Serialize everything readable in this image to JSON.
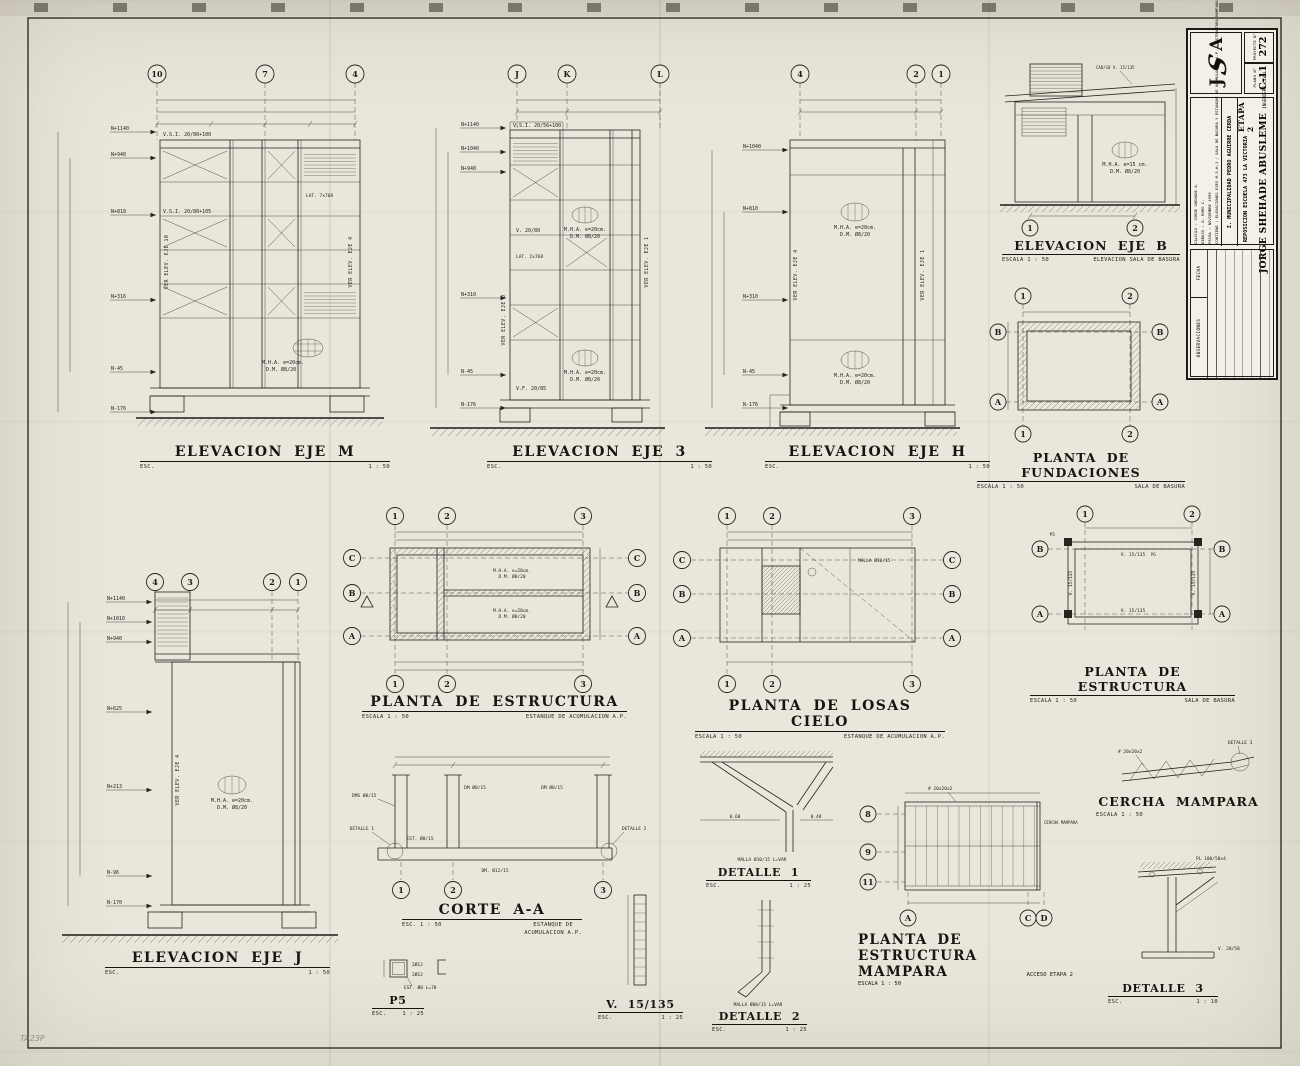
{
  "sheet": {
    "corner_mark": "TA23P"
  },
  "tb": {
    "logo_j": "J",
    "logo_s": "S",
    "logo_a": "A",
    "proj_no_label": "PROYECTO N°",
    "proj_no": "272",
    "plan_no_label": "PLANO N°",
    "plan_no": "C-11",
    "engineer": "JORGE SHEHADE ABUSLEME",
    "eng_title": "INGENIERO CIVIL",
    "etapa": "ETAPA 2",
    "proy_label": "PROYECTO :",
    "proy": "REPOSICION ESCUELA 473 LA VICTORIA",
    "cli_label": "CLIENTE :",
    "cli": "I. MUNICIPALIDAD PEDRO AGUIRRE CERDA",
    "f1": "CALCULO : JORGE SHEHADE A.",
    "f2": "DIBUJO : A. ROMO C.",
    "f3": "FECHA : NOVIEMBRE 1999",
    "contiene": "CONTIENE : ELEVACIONES EJES M-3-H-J / SALA DE BASURA Y ESTANQUE DE ACUMULACION A.P. / ESTRUCTURA MAMPARA",
    "fecha_col": "FECHA",
    "obs_col": "OBSERVACIONES"
  },
  "panels": {
    "m": {
      "title": "ELEVACION EJE M",
      "esc": "ESC.",
      "scale": "1 : 50",
      "bubbles": [
        "10",
        "7",
        "4"
      ],
      "levels": [
        "N+1140",
        "N+940",
        "N+818",
        "N+316",
        "N-45",
        "N-176"
      ],
      "a1": "V.S.I. 20/80+100",
      "a2": "V.S.I. 20/80+105",
      "a3": "LAT. 7x768",
      "mha1": "M.H.A.  e=20cm.",
      "mha2": "D.M.  Ø8/20",
      "v1": "VER ELEV. EJE 10",
      "v2": "VER ELEV. EJE 4"
    },
    "e3": {
      "title": "ELEVACION EJE 3",
      "esc": "ESC.",
      "scale": "1 : 50",
      "bubbles": [
        "J",
        "K",
        "L"
      ],
      "levels": [
        "N+1140",
        "N+1040",
        "N+940",
        "N+310",
        "N-45",
        "N-176"
      ],
      "a1": "V.S.I. 20/56+100",
      "a2": "V. 20/80",
      "a3": "V.F. 20/85",
      "a4": "LAT. 2x768",
      "mha1": "M.H.A.  e=20cm.",
      "mha2": "D.M.  Ø8/20",
      "v1": "VER ELEV. EJE J",
      "v2": "VER ELEV. EJE 1"
    },
    "h": {
      "title": "ELEVACION EJE H",
      "esc": "ESC.",
      "scale": "1 : 50",
      "bubbles": [
        "4",
        "2",
        "1"
      ],
      "levels": [
        "N+1040",
        "N+810",
        "N+310",
        "N-45",
        "N-176"
      ],
      "mha1": "M.H.A.  e=20cm.",
      "mha2": "D.M.  Ø8/20",
      "v1": "VER ELEV. EJE 4",
      "v2": "VER ELEV. EJE 1"
    },
    "b": {
      "title": "ELEVACION EJE B",
      "escala": "ESCALA 1 : 50",
      "sub": "ELEVACION SALA DE BASURA",
      "bubbles": [
        "1",
        "2"
      ],
      "a1": "CAD/10  V. 15/135",
      "mha1": "M.H.A.  e=15 cm.",
      "mha2": "D.M.  Ø8/20"
    },
    "fund": {
      "title": "PLANTA DE FUNDACIONES",
      "escala": "ESCALA 1 : 50",
      "sub": "SALA DE BASURA",
      "top": [
        "1",
        "2"
      ],
      "bot": [
        "1",
        "2"
      ],
      "left": [
        "B",
        "A"
      ],
      "right": [
        "B",
        "A"
      ]
    },
    "pe": {
      "title": "PLANTA DE ESTRUCTURA",
      "escala": "ESCALA 1 : 50",
      "sub": "ESTANQUE DE ACUMULACION A.P.",
      "top": [
        "1",
        "2",
        "3"
      ],
      "bot": [
        "1",
        "2",
        "3"
      ],
      "left": [
        "C",
        "B",
        "A"
      ],
      "right": [
        "C",
        "B",
        "A"
      ],
      "mha1": "M.H.A. e=20cm.",
      "mha2": "D.M. Ø8/20"
    },
    "losas": {
      "title": "PLANTA DE LOSAS CIELO",
      "escala": "ESCALA 1 : 50",
      "sub": "ESTANQUE DE ACUMULACION A.P.",
      "top": [
        "1",
        "2",
        "3"
      ],
      "bot": [
        "1",
        "2",
        "3"
      ],
      "left": [
        "C",
        "B",
        "A"
      ],
      "right": [
        "C",
        "B",
        "A"
      ],
      "a1": "MALLA Ø10/15"
    },
    "peb": {
      "title": "PLANTA DE ESTRUCTURA",
      "escala": "ESCALA 1 : 50",
      "sub": "SALA DE BASURA",
      "top": [
        "1",
        "2"
      ],
      "left": [
        "B",
        "A"
      ],
      "right": [
        "B",
        "A"
      ],
      "a1": "V. 15/135",
      "a2": "P5",
      "a3": "PG"
    },
    "j": {
      "title": "ELEVACION EJE J",
      "esc": "ESC.",
      "scale": "1 : 50",
      "bubbles": [
        "4",
        "3",
        "2",
        "1"
      ],
      "levels": [
        "N+1140",
        "N+1010",
        "N+940",
        "N+625",
        "N+213",
        "N-96",
        "N-170"
      ],
      "mha1": "M.H.A.  e=20cm.",
      "mha2": "D.M.  Ø8/20",
      "v1": "VER ELEV. EJE 4"
    },
    "corte": {
      "title": "CORTE A-A",
      "esc": "ESC. 1 : 50",
      "sub1": "ESTANQUE DE",
      "sub2": "ACUMULACION A.P.",
      "bot": [
        "1",
        "2",
        "3"
      ],
      "r1": "DMS Ø8/15",
      "r2": "DM Ø8/15",
      "r3": "EST. Ø8/15",
      "r4": "DM. Ø12/15",
      "d1": "DETALLE 1",
      "d2": "DETALLE 2"
    },
    "p5": {
      "title": "P5",
      "esc": "ESC.",
      "scale": "1 : 25",
      "a1": "2Ø12",
      "a2": "EST. Ø8  L=70"
    },
    "v15": {
      "title": "V. 15/135",
      "esc": "ESC.",
      "scale": "1 : 25"
    },
    "det1": {
      "title": "DETALLE 1",
      "esc": "ESC.",
      "scale": "1 : 25",
      "a1": "MALLA Ø10/15 L=VAR",
      "d1": "0.60",
      "d2": "0.48"
    },
    "det2": {
      "title": "DETALLE 2",
      "esc": "ESC.",
      "scale": "1 : 25",
      "a1": "MALLA Ø08/15 L=VAR"
    },
    "det3": {
      "title": "DETALLE 3",
      "esc": "ESC.",
      "scale": "1 : 10",
      "a1": "PL 100/50x4",
      "a2": "V. 20/50"
    },
    "mam": {
      "title1": "PLANTA DE ESTRUCTURA",
      "title2": "MAMPARA",
      "sub": "ACCESO ETAPA 2",
      "escala": "ESCALA 1 : 50",
      "left": [
        "8",
        "9",
        "11"
      ],
      "bot": [
        "A",
        "C",
        "D"
      ],
      "a1": "# 20x20x2",
      "a2": "CERCHA MAMPARA"
    },
    "cercha": {
      "title": "CERCHA MAMPARA",
      "escala": "ESCALA 1 : 50",
      "a1": "DETALLE 3",
      "a2": "# 20x20x2"
    }
  }
}
